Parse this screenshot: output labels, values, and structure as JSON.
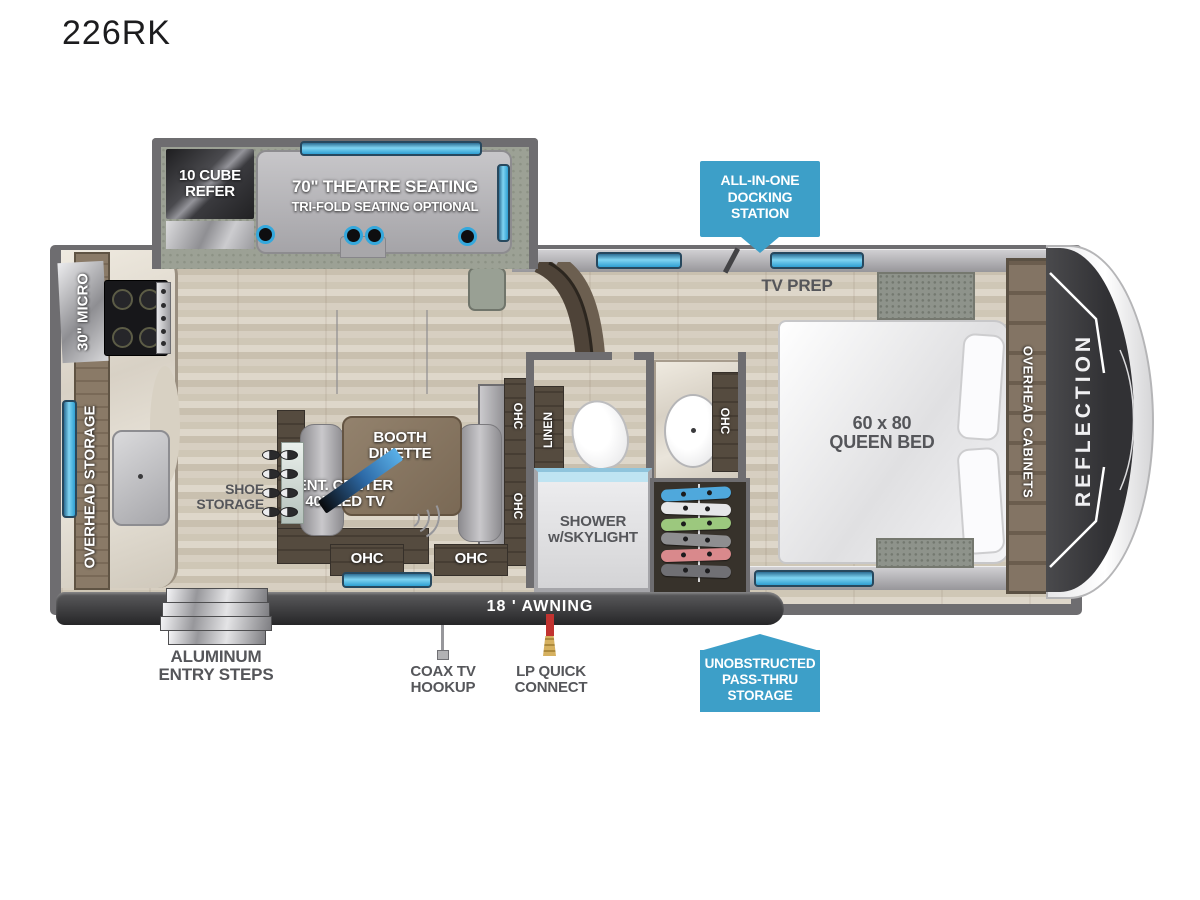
{
  "title": "226RK",
  "colors": {
    "badge_blue": "#3D9FC8",
    "window_blue": "#7FD4F2",
    "wall_gray": "#6E6D70",
    "awning_dark": "#2F2F31",
    "floor_wood": "#D9D2C4",
    "cap_dark": "#3A3A3D",
    "label_dark": "#55565A",
    "hangers": [
      "#4FA8DC",
      "#E6E6E8",
      "#9CC87E",
      "#8E8E90",
      "#D9898C",
      "#707074"
    ]
  },
  "slideout": {
    "refer_label": "10 CUBE\nREFER",
    "theatre_label": "70\" THEATRE SEATING",
    "theatre_sub_label": "TRI-FOLD SEATING OPTIONAL"
  },
  "kitchen": {
    "micro_label": "30\" MICRO",
    "overhead_storage_label": "OVERHEAD STORAGE",
    "shoe_storage_label": "SHOE\nSTORAGE"
  },
  "dinette": {
    "booth_label": "BOOTH\nDINETTE",
    "ent_center_label": "ENT. CENTER\n40\" LED TV",
    "ohc_label": "OHC"
  },
  "bath": {
    "linen_label": "LINEN",
    "shower_label": "SHOWER\nw/SKYLIGHT",
    "ohc_label": "OHC"
  },
  "bedroom": {
    "tv_prep_label": "TV PREP",
    "bed_label": "60 x 80\nQUEEN BED",
    "overhead_cabinets_label": "OVERHEAD CABINETS"
  },
  "brand": {
    "name": "REFLECTION"
  },
  "callouts": {
    "docking_label": "ALL-IN-ONE\nDOCKING\nSTATION",
    "passthru_label": "UNOBSTRUCTED\nPASS-THRU\nSTORAGE",
    "awning_label": "18 ' AWNING",
    "entry_steps_label": "ALUMINUM\nENTRY STEPS",
    "coax_label": "COAX TV\nHOOKUP",
    "lp_label": "LP QUICK\nCONNECT"
  }
}
